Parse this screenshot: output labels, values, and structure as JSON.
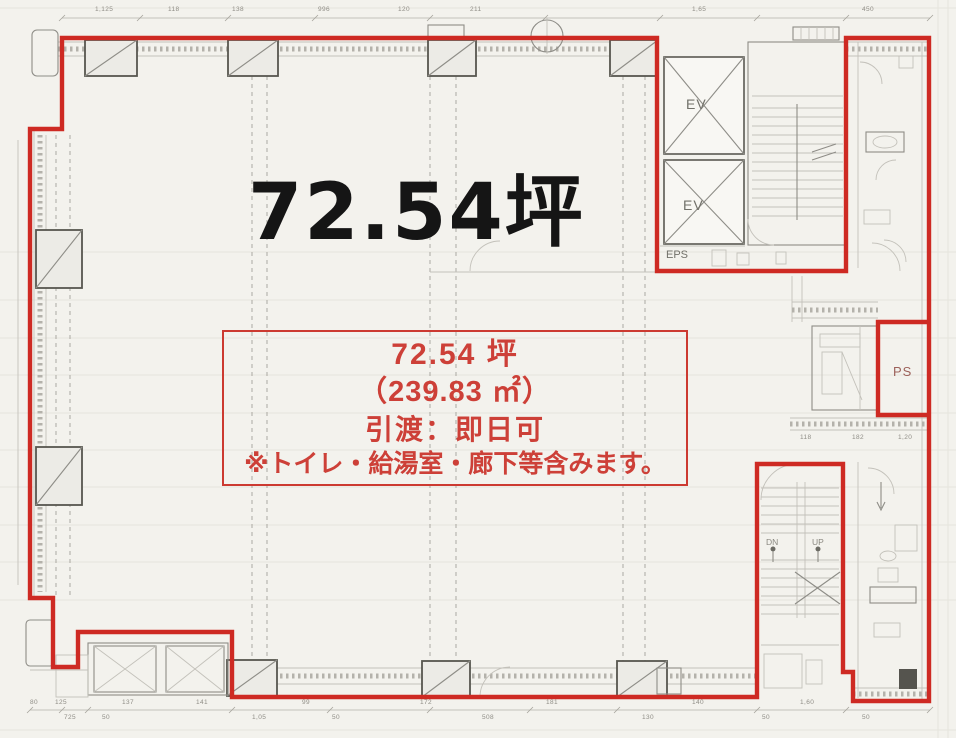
{
  "title": {
    "area_large": "72.54坪"
  },
  "info_box": {
    "line1": "72.54 坪",
    "line2": "（239.83 ㎡）",
    "line3": "引渡：即日可",
    "line4": "※トイレ・給湯室・廊下等含みます。"
  },
  "labels": {
    "elevator_top": "EV",
    "elevator_bottom": "EV",
    "eps": "EPS",
    "ps": "PS",
    "stair_down": "DN",
    "stair_up": "UP"
  },
  "dimensions": {
    "top": [
      "1,125",
      "118",
      "138",
      "996",
      "120",
      "211",
      "1,65",
      "450"
    ],
    "bottom_a": [
      "80",
      "125",
      "137",
      "141",
      "99",
      "172",
      "181",
      "140",
      "1,60"
    ],
    "bottom_b": [
      "725",
      "50",
      "1,05",
      "50",
      "508",
      "130",
      "50",
      "50"
    ],
    "right": [
      "118",
      "182",
      "1,20"
    ]
  },
  "colors": {
    "lease_line": "#ce2a23",
    "info_border": "#cc3a31",
    "info_text": "#cd4038",
    "drawing_gray": "#8e8d87",
    "column_gray": "#57564f",
    "paper": "#f3f2ed"
  }
}
